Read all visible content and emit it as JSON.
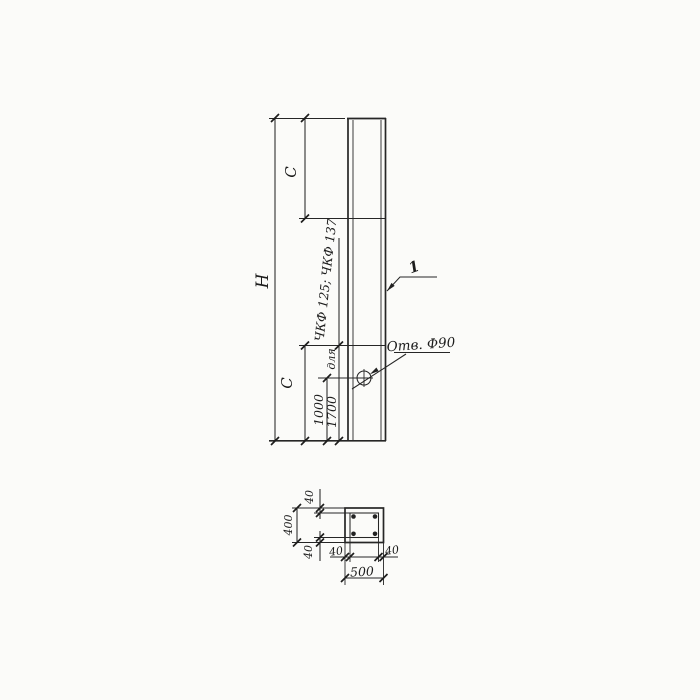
{
  "page": {
    "paper_color": "#fbfbf9",
    "ink_color": "#262626"
  },
  "elevation_view": {
    "overall_height_label": "Н",
    "top_segment_label": "С",
    "bottom_segment_label": "С",
    "hole_offset_dim": "1000",
    "segment_dim": "1700",
    "note_prefix": "для",
    "note_marks": "ЧКФ 125; ЧКФ 137",
    "hole_callout": "Отв. Ф90",
    "item_number": "1"
  },
  "section_view": {
    "overall_width_dim": "500",
    "overall_height_dim": "400",
    "wall_top_dim": "40",
    "wall_bottom_dim": "40",
    "wall_left_dim": "40",
    "wall_right_dim": "40"
  }
}
